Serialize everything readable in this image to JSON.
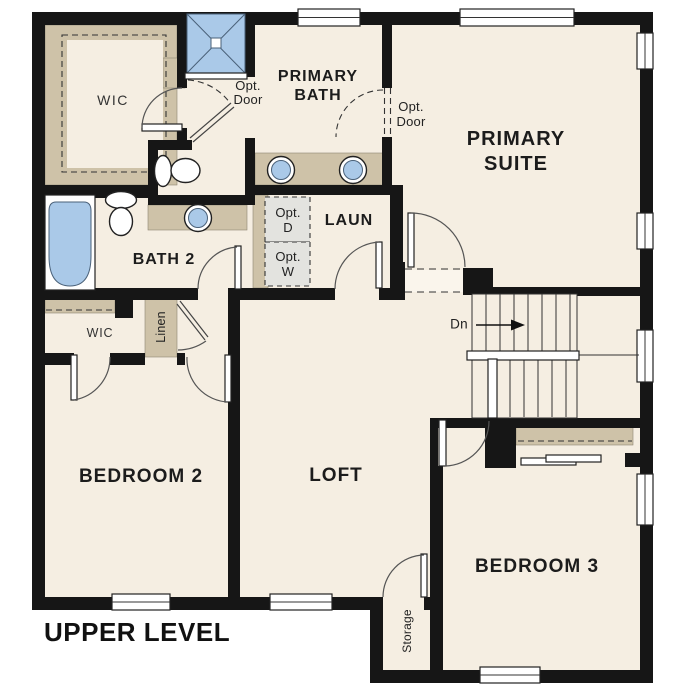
{
  "title": {
    "label": "UPPER LEVEL"
  },
  "rooms": {
    "primary_wic": {
      "label": "WIC"
    },
    "primary_bath": {
      "line1": "PRIMARY",
      "line2": "BATH"
    },
    "primary_suite": {
      "line1": "PRIMARY",
      "line2": "SUITE"
    },
    "bath_2": {
      "label": "BATH 2"
    },
    "laundry": {
      "label": "LAUN"
    },
    "wic_2": {
      "label": "WIC"
    },
    "linen": {
      "label": "Linen"
    },
    "bedroom_2": {
      "label": "BEDROOM 2"
    },
    "loft": {
      "label": "LOFT"
    },
    "bedroom_3": {
      "label": "BEDROOM 3"
    },
    "storage": {
      "label": "Storage"
    }
  },
  "annotations": {
    "opt_door_shower": {
      "line1": "Opt.",
      "line2": "Door"
    },
    "opt_door_suite": {
      "line1": "Opt.",
      "line2": "Door"
    },
    "opt_dryer": {
      "line1": "Opt.",
      "line2": "D"
    },
    "opt_washer": {
      "line1": "Opt.",
      "line2": "W"
    },
    "stairs_down": {
      "label": "Dn"
    }
  },
  "fixtures": {
    "shower": "shower-icon",
    "bathtub": "bathtub-icon",
    "primary_toilet": "toilet-icon",
    "bath2_toilet": "toilet-icon",
    "primary_sink_left": "sink-icon",
    "primary_sink_right": "sink-icon",
    "bath2_sink": "sink-icon",
    "stairs": "staircase-down-icon"
  },
  "colors": {
    "wall": "#161616",
    "floor": "#f5eee2",
    "casework": "#cec2a8",
    "fixture_blue": "#aac9e8",
    "optional_appliance": "#e3e3df",
    "background": "#ffffff"
  }
}
